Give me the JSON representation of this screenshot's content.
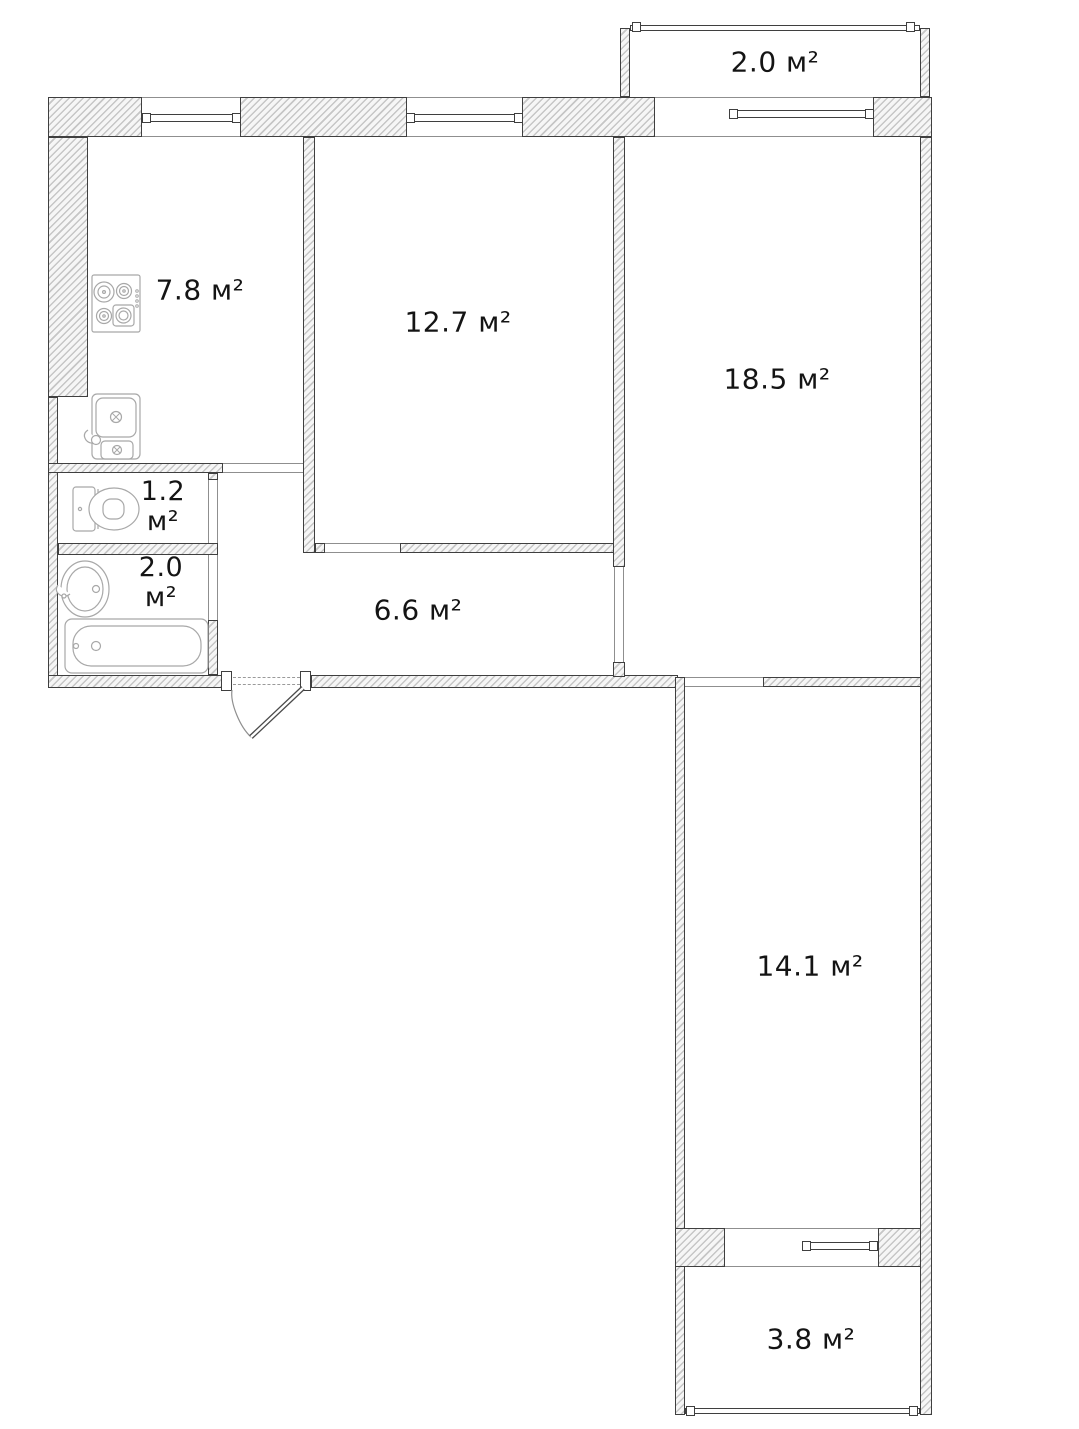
{
  "rooms": {
    "kitchen": {
      "area": "7.8",
      "unit": "м²"
    },
    "room_12_7": {
      "area": "12.7",
      "unit": "м²"
    },
    "room_18_5": {
      "area": "18.5",
      "unit": "м²"
    },
    "balcony_top": {
      "area": "2.0",
      "unit": "м²"
    },
    "toilet": {
      "area": "1.2",
      "unit": "м²"
    },
    "bathroom": {
      "area": "2.0",
      "unit": "м²"
    },
    "hallway": {
      "area": "6.6",
      "unit": "м²"
    },
    "room_14_1": {
      "area": "14.1",
      "unit": "м²"
    },
    "balcony_bottom": {
      "area": "3.8",
      "unit": "м²"
    }
  },
  "icons": [
    "stove-icon",
    "kitchen-sink-icon",
    "toilet-icon",
    "bathroom-sink-icon",
    "bathtub-icon",
    "entrance-door-icon",
    "window-icon",
    "balcony-rail-icon"
  ],
  "colors": {
    "background": "#ffffff",
    "wall_line": "#3f3f3f",
    "wall_hatch": "#c6c6c6",
    "fixture_line": "#a8a8a8",
    "text": "#141414"
  }
}
